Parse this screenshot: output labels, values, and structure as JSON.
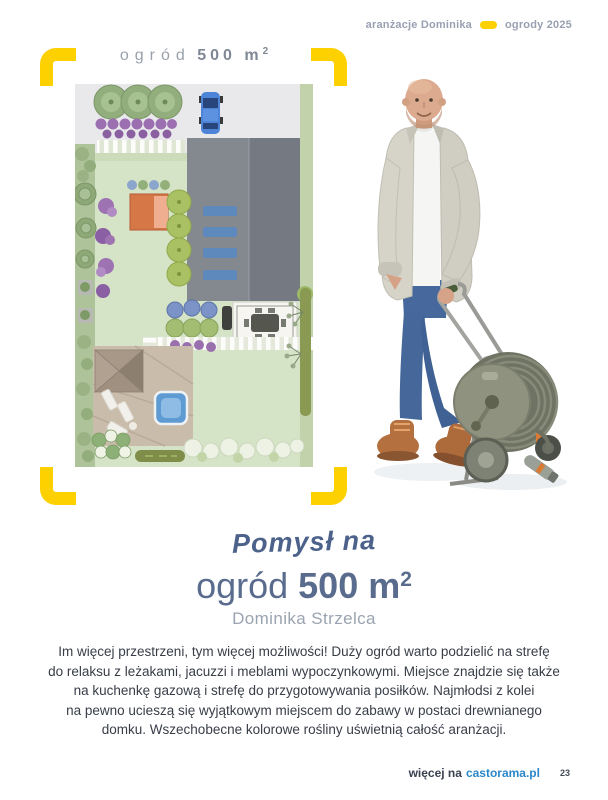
{
  "header": {
    "left_label": "aranżacje Dominika",
    "right_label": "ogrody 2025"
  },
  "plan": {
    "title_regular": "ogród",
    "title_bold": "500 m",
    "title_sup": "2"
  },
  "idea": {
    "script_line": "Pomysł na",
    "title_regular": "ogród",
    "title_bold": "500 m",
    "title_sup": "2",
    "author": "Dominika Strzelca"
  },
  "body": {
    "text": "Im więcej przestrzeni, tym więcej możliwości! Duży ogród warto podzielić na strefę\ndo relaksu z leżakami, jacuzzi i meblami wypoczynkowymi. Miejsce znajdzie się także\nna kuchenkę gazową i strefę do przygotowywania posiłków. Najmłodsi z kolei\nna pewno ucieszą się wyjątkowym miejscem do zabawy w postaci drewnianego\ndomku. Wszechobecne kolorowe rośliny uświetnią całość aranżacji."
  },
  "footer": {
    "prefix": "więcej na",
    "link": "castorama.pl",
    "page": "23"
  },
  "colors": {
    "accent_yellow": "#fdd000",
    "link_blue": "#2b87c8",
    "heading_blue": "#5a6c8e",
    "header_gray": "#98a0b2",
    "text_dark": "#383d47",
    "author_gray": "#9aa3b0",
    "plan_title_gray": "#99a1ab"
  }
}
